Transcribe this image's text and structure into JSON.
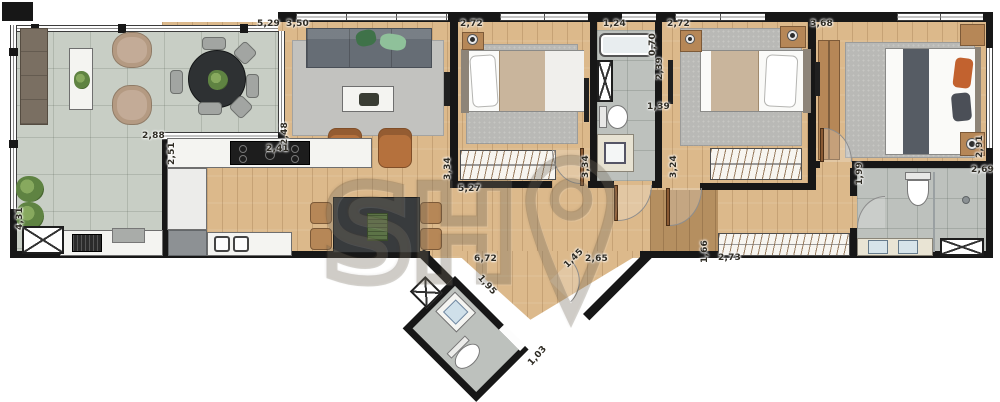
{
  "watermark": "SH",
  "dims": [
    "5,29",
    "3,50",
    "2,72",
    "1,24",
    "2,72",
    "3,68",
    "2,88",
    "2,48",
    "2,51",
    "2,41",
    "3,34",
    "5,27",
    "0,70",
    "2,39",
    "1,39",
    "3,34",
    "3,24",
    "2,91",
    "1,99",
    "2,69",
    "1,66",
    "2,73",
    "6,72",
    "1,45",
    "2,65",
    "1,95",
    "1,03",
    "4,31"
  ]
}
